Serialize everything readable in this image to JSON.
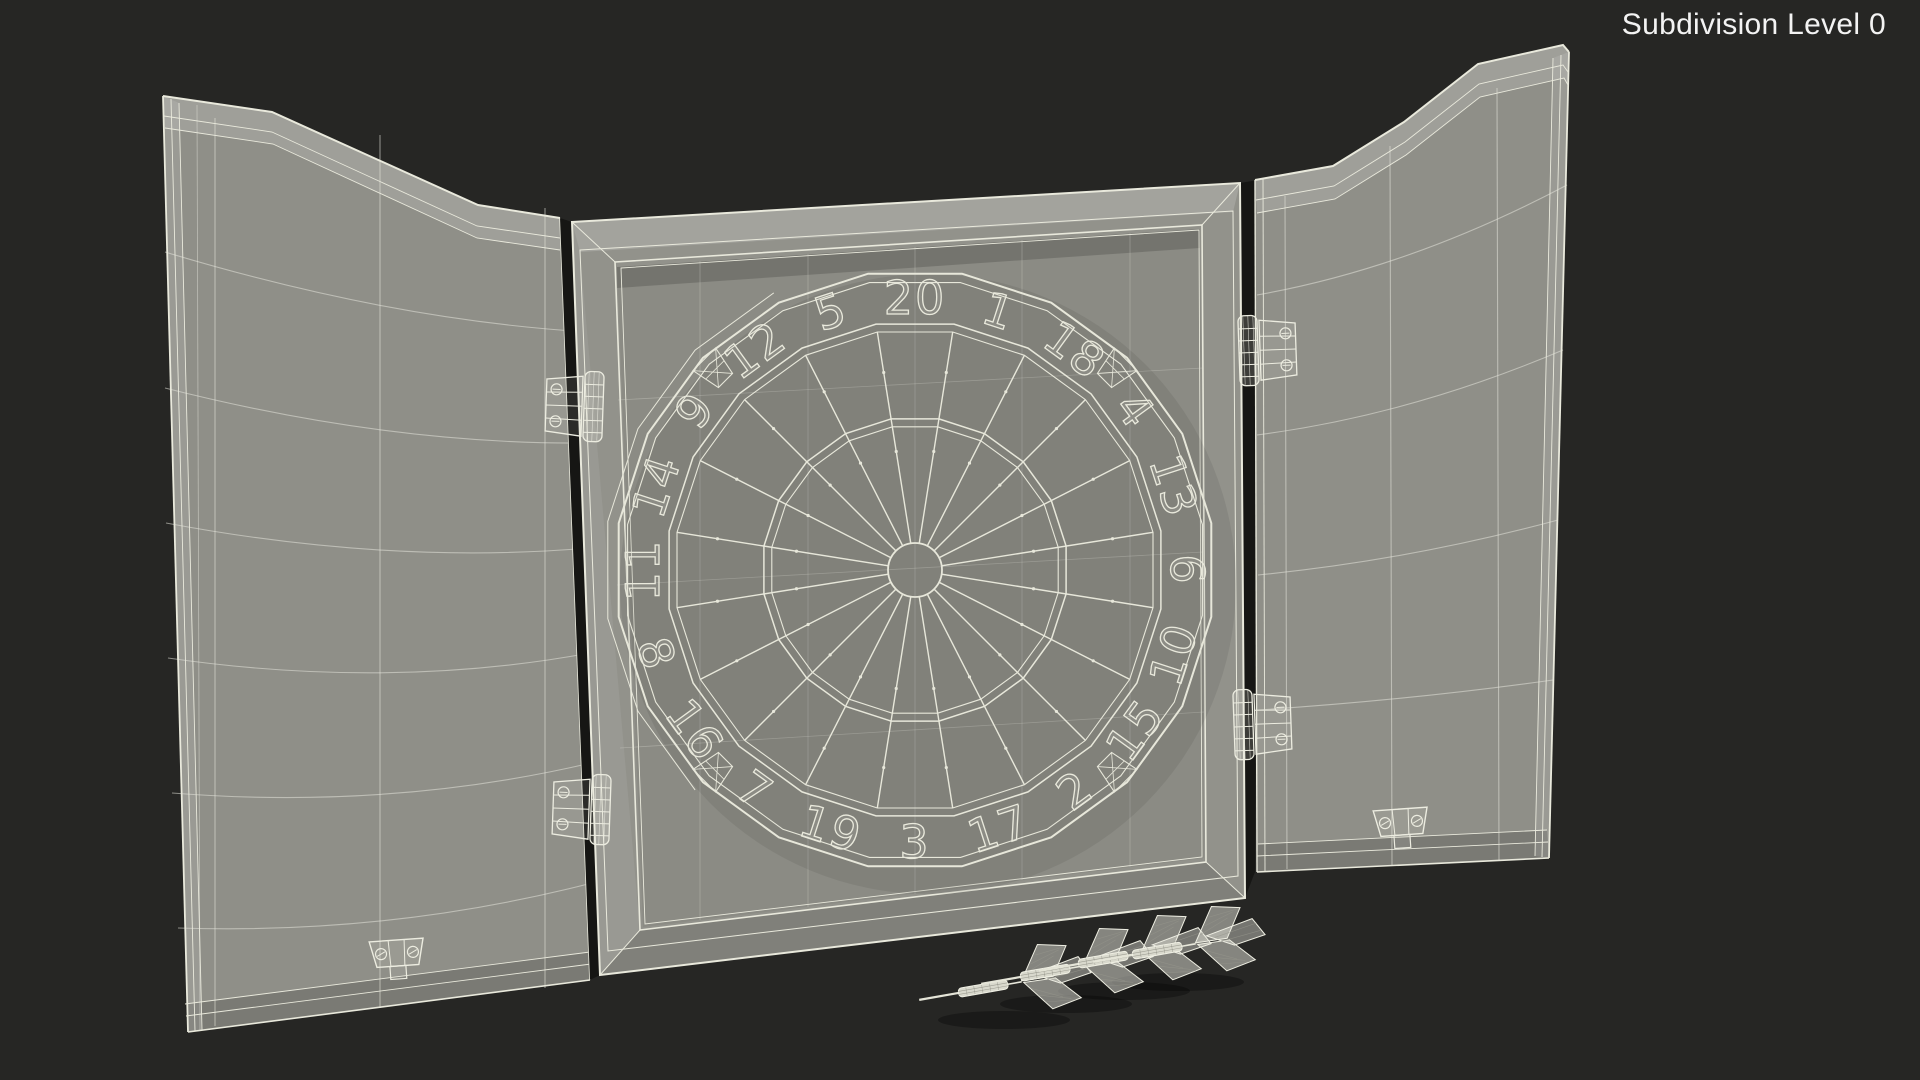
{
  "viewport": {
    "hud_label": "Subdivision Level 0",
    "background_color": "#262624",
    "wireframe_color": "#e7e7da",
    "surface_color": "#90908a",
    "hud_text_color": "#f3f3f3"
  },
  "dartboard": {
    "numbers_clockwise_from_top": [
      "20",
      "1",
      "18",
      "4",
      "13",
      "6",
      "10",
      "15",
      "2",
      "17",
      "3",
      "19",
      "7",
      "16",
      "8",
      "11",
      "14",
      "9",
      "12",
      "5"
    ]
  },
  "counts": {
    "darts": 4,
    "hinges": 4,
    "latches": 2
  }
}
